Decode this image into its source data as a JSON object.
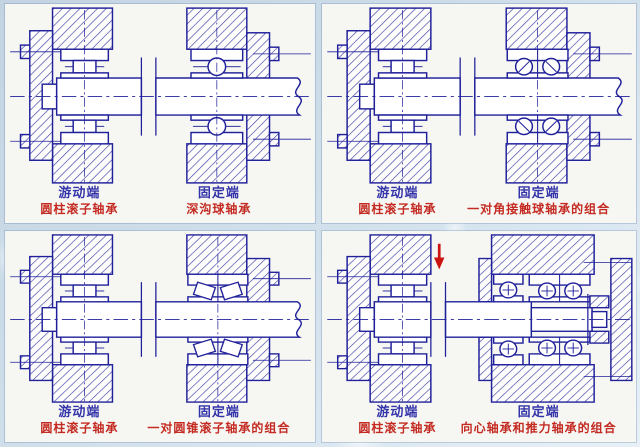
{
  "page": {
    "background": "#c4d3e2",
    "panel_background": "#f6f7f3"
  },
  "colors": {
    "line": "#20209a",
    "hatch": "#4646ae",
    "label_blue": "#3434aa",
    "label_red": "#c42a22",
    "arrow_red": "#cc1410"
  },
  "panels": [
    {
      "name": "deep-groove-ball-arrangement",
      "left_end": {
        "role": "游动端",
        "bearing": "圆柱滚子轴承",
        "type": "cylindrical-roller"
      },
      "right_end": {
        "role": "固定端",
        "bearing": "深沟球轴承",
        "type": "deep-groove-ball"
      },
      "arrow": false
    },
    {
      "name": "angular-contact-pair-arrangement",
      "left_end": {
        "role": "游动端",
        "bearing": "圆柱滚子轴承",
        "type": "cylindrical-roller"
      },
      "right_end": {
        "role": "固定端",
        "bearing": "一对角接触球轴承的组合",
        "type": "angular-contact-pair"
      },
      "arrow": false
    },
    {
      "name": "tapered-roller-pair-arrangement",
      "left_end": {
        "role": "游动端",
        "bearing": "圆柱滚子轴承",
        "type": "cylindrical-roller"
      },
      "right_end": {
        "role": "固定端",
        "bearing": "一对圆锥滚子轴承的组合",
        "type": "tapered-roller-pair"
      },
      "arrow": false
    },
    {
      "name": "radial-thrust-combo-arrangement",
      "left_end": {
        "role": "游动端",
        "bearing": "圆柱滚子轴承",
        "type": "cylindrical-roller"
      },
      "right_end": {
        "role": "固定端",
        "bearing": "向心轴承和推力轴承的组合",
        "type": "radial-thrust-combo"
      },
      "arrow": true
    }
  ]
}
